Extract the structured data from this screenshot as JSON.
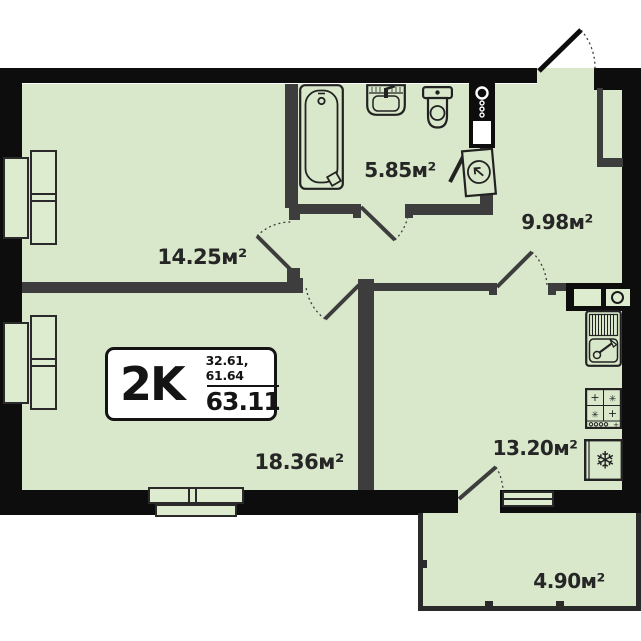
{
  "badge": {
    "type": "2K",
    "upper": "32.61, 61.64",
    "total": "63.11"
  },
  "rooms": [
    {
      "name": "room-1",
      "area": "14.25м²"
    },
    {
      "name": "bathroom",
      "area": "5.85м²"
    },
    {
      "name": "hallway",
      "area": "9.98м²"
    },
    {
      "name": "room-2",
      "area": "18.36м²"
    },
    {
      "name": "kitchen",
      "area": "13.20м²"
    },
    {
      "name": "balcony",
      "area": "4.90м²"
    }
  ],
  "colors": {
    "room_fill": "#d9e8cb",
    "outer_wall": "#0d0d0d",
    "inner_wall": "#3d3d3d",
    "background": "#ffffff",
    "text": "#262626"
  },
  "icons": {
    "bathtub": "rounded-rect outline with drain circle",
    "washbasin": "rect with bowl and tap",
    "toilet": "tank + oval bowl",
    "water-heater": "box with circle arrow",
    "plumbing-riser": "circles + square on black shaft",
    "vent-duct": "squares with circle on black shaft",
    "kitchen-sink": "drainer + bowl with tap",
    "stove": "2x2 burners + and ✳ with knobs",
    "fridge": "❄"
  }
}
